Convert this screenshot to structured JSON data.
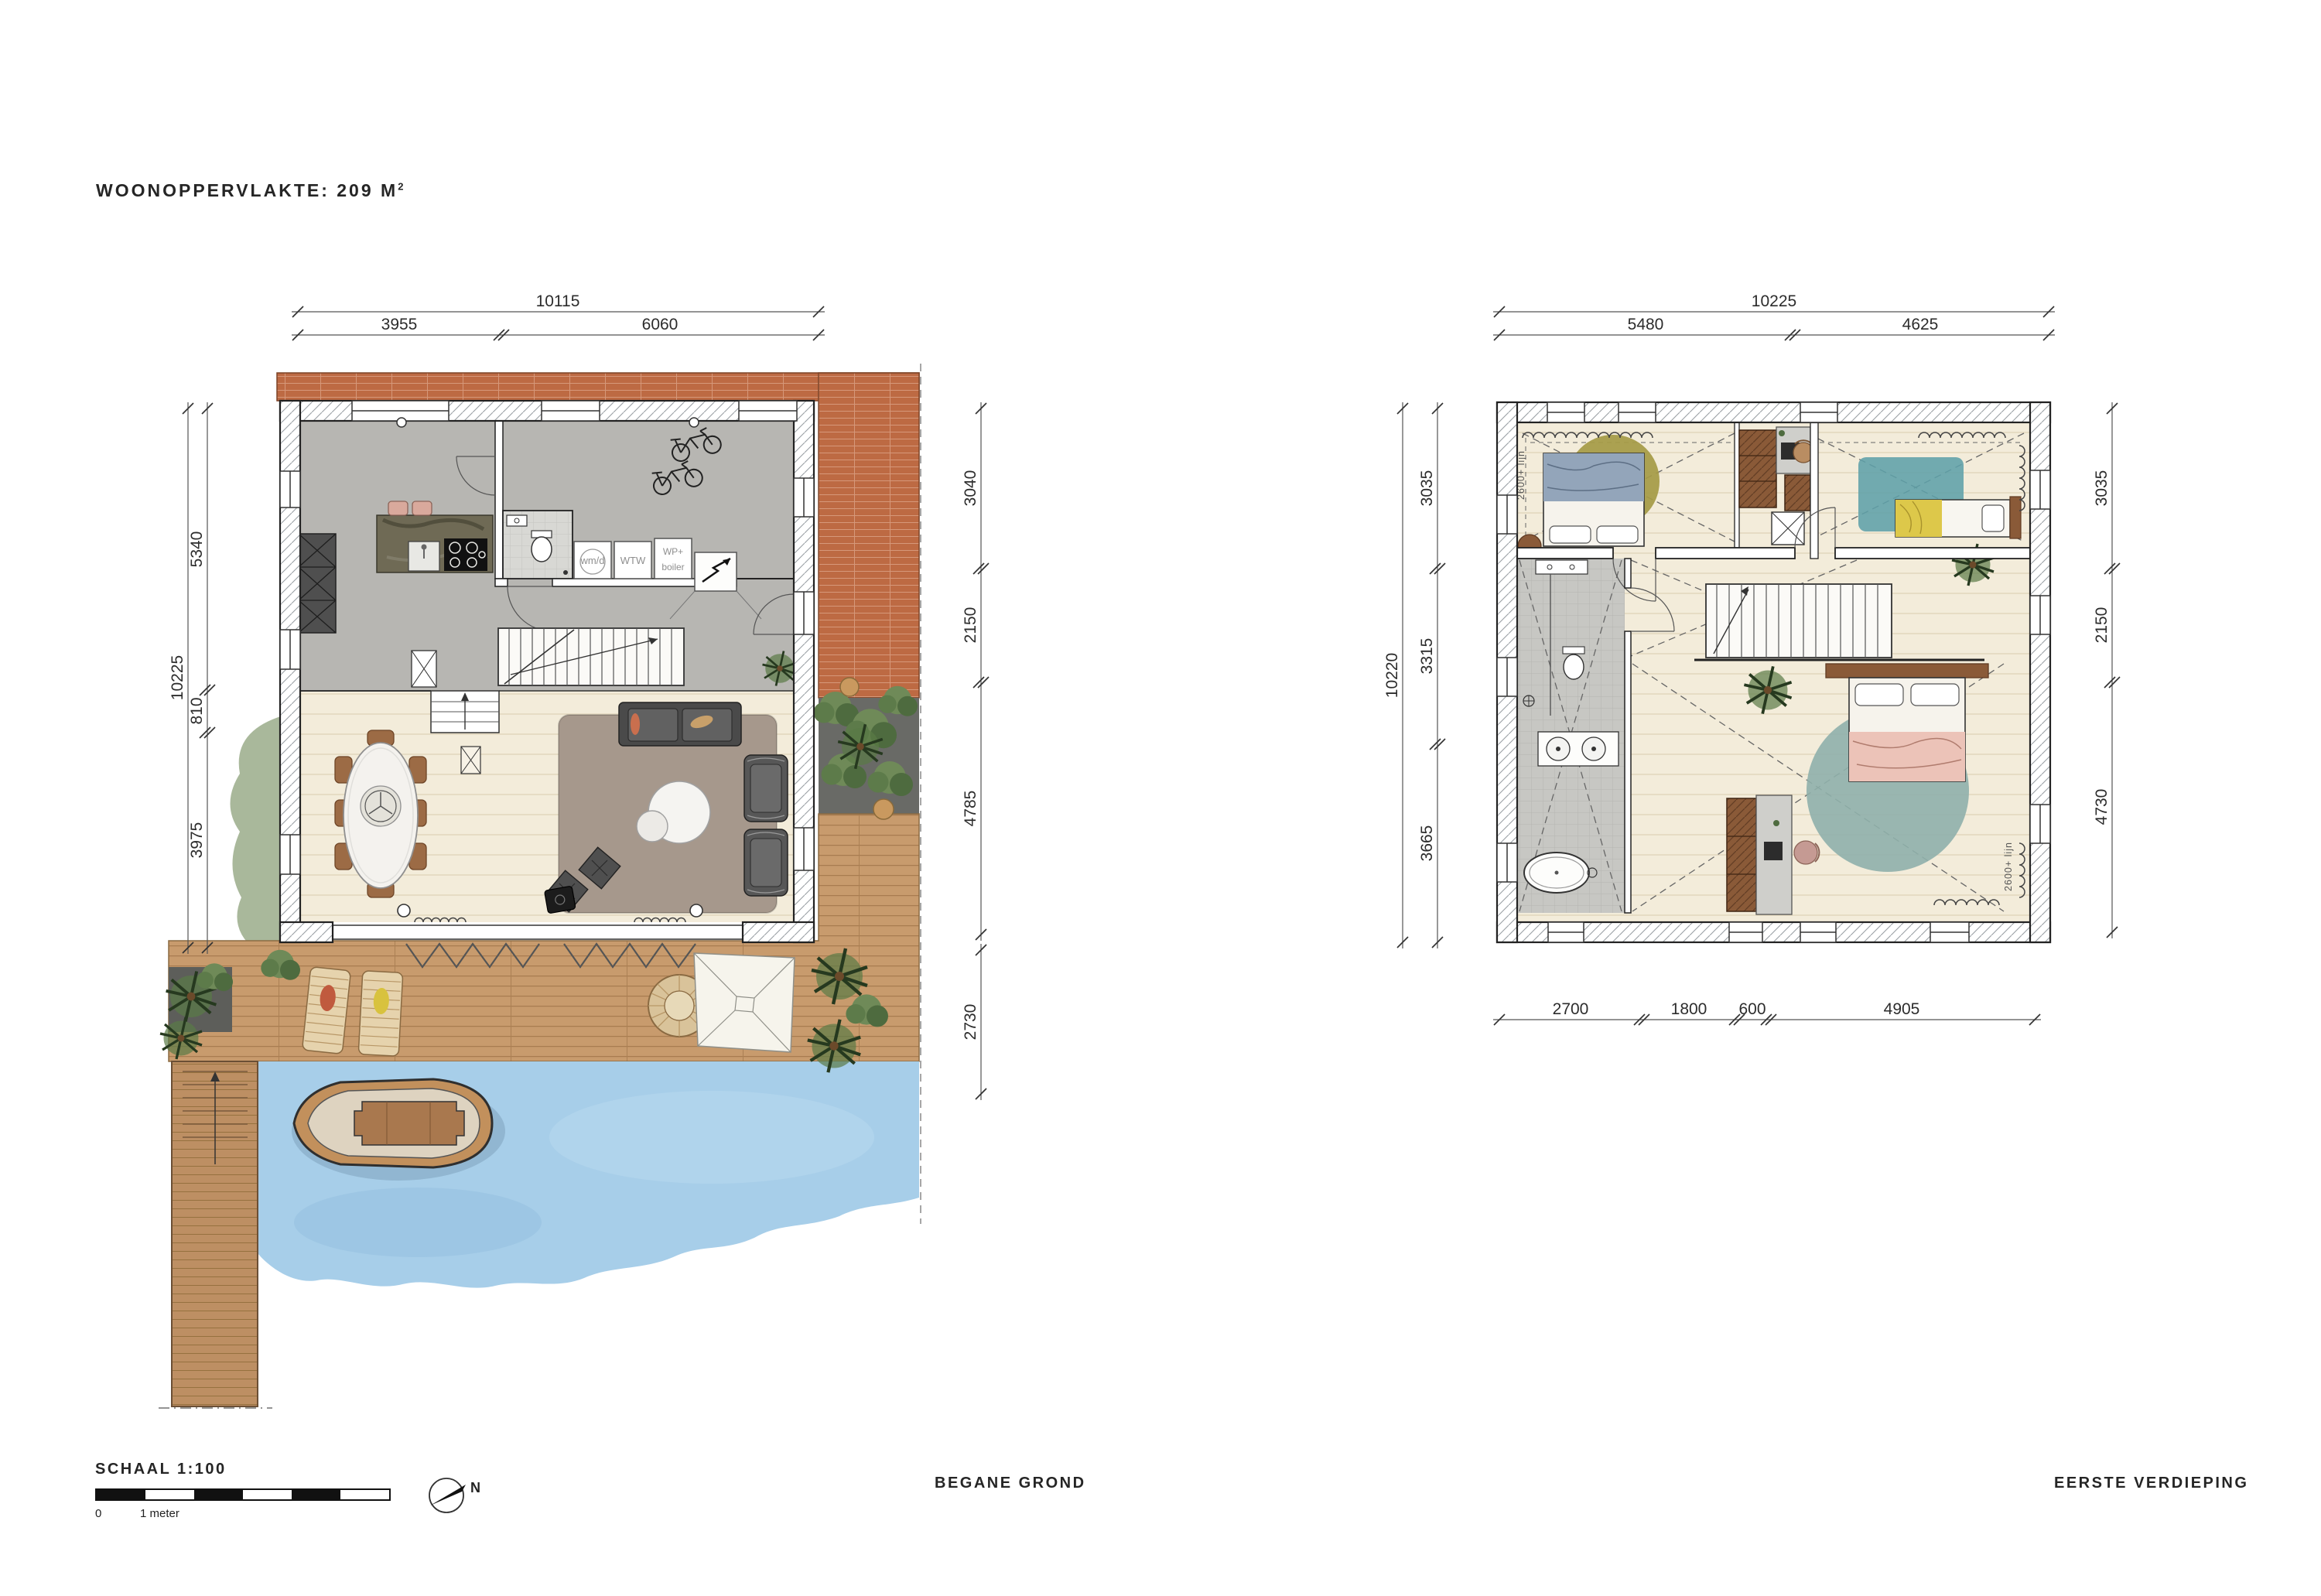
{
  "sheet": {
    "title": "WOONOPPERVLAKTE: 209 M",
    "title_sup": "2",
    "scale": {
      "label": "SCHAAL 1:100",
      "zero": "0",
      "one_meter": "1 meter"
    },
    "north": "N",
    "footer": {
      "ground": "BEGANE GROND",
      "first": "EERSTE VERDIEPING"
    }
  },
  "ground_floor": {
    "dims": {
      "top_total": "10115",
      "top_segments": [
        "3955",
        "6060"
      ],
      "left_total": "10225",
      "left_segments": [
        "5340",
        "810",
        "3975"
      ],
      "right_segments": [
        "3040",
        "2150",
        "4785"
      ],
      "right_lower": "2730"
    },
    "labels": {
      "wm_d": "wm/d",
      "wtw": "WTW",
      "wp": "WP+",
      "boiler": "boiler"
    }
  },
  "first_floor": {
    "dims": {
      "top_total": "10225",
      "top_segments": [
        "5480",
        "4625"
      ],
      "left_total": "10220",
      "left_segments": [
        "3035",
        "3315",
        "3665"
      ],
      "right_segments": [
        "3035",
        "2150",
        "4730"
      ],
      "bottom_segments": [
        "2700",
        "1800",
        "600",
        "4905"
      ]
    },
    "annotations": {
      "height_line_left": "2600+ lijn",
      "height_line_right": "2600+ lijn"
    }
  }
}
